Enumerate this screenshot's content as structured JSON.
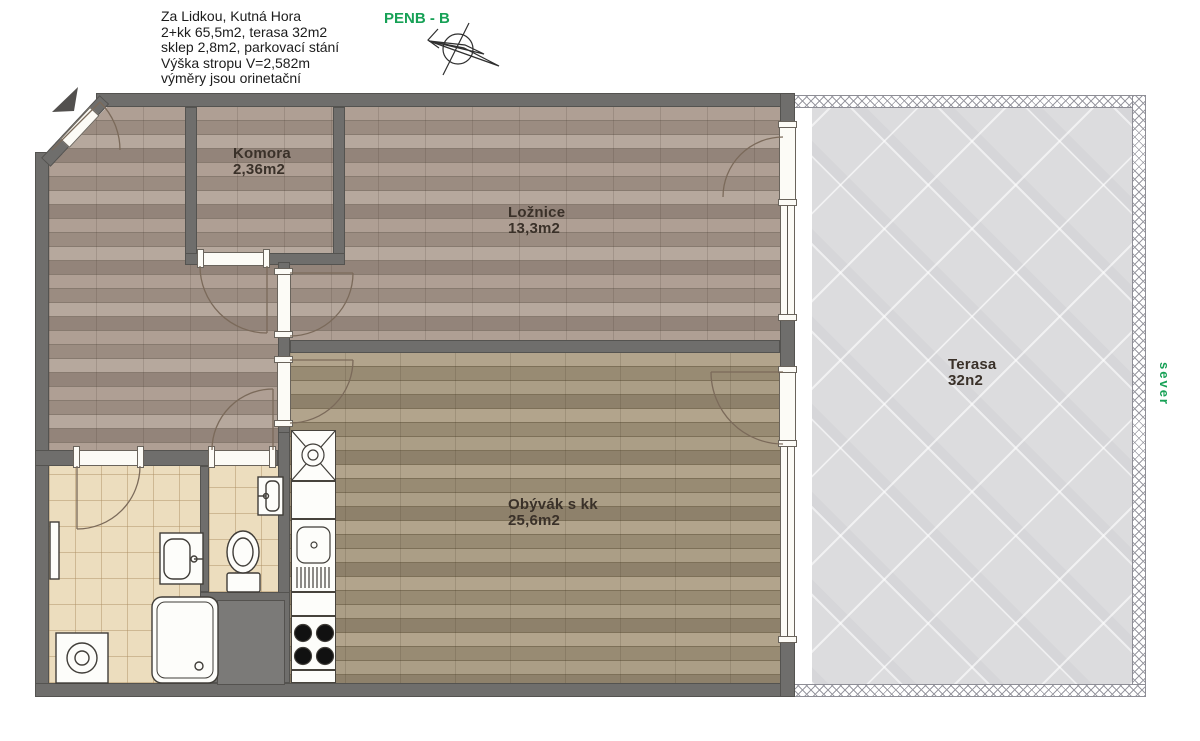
{
  "header": {
    "lines": [
      "Za Lidkou, Kutná Hora",
      "2+kk 65,5m2, terasa 32m2",
      "sklep 2,8m2, parkovací stání",
      "Výška stropu V=2,582m",
      "výměry jsou orinetační"
    ],
    "energy_label": "PENB - B",
    "north_label": "sever"
  },
  "rooms": {
    "komora": {
      "name": "Komora",
      "area": "2,36m2"
    },
    "loznice": {
      "name": "Ložnice",
      "area": "13,3m2"
    },
    "terasa": {
      "name": "Terasa",
      "area": "32n2"
    },
    "obyvak": {
      "name": "Obývák s kk",
      "area": "25,6m2"
    }
  },
  "colors": {
    "accent_green": "#17a156",
    "wall_gray": "#6f6e6c",
    "wood_hall": "#a2948a",
    "wood_living": "#a3957e",
    "bath_tile": "#ecddbe",
    "terrace_gray": "#dcdcde",
    "text_dark": "#1c1c1c"
  }
}
